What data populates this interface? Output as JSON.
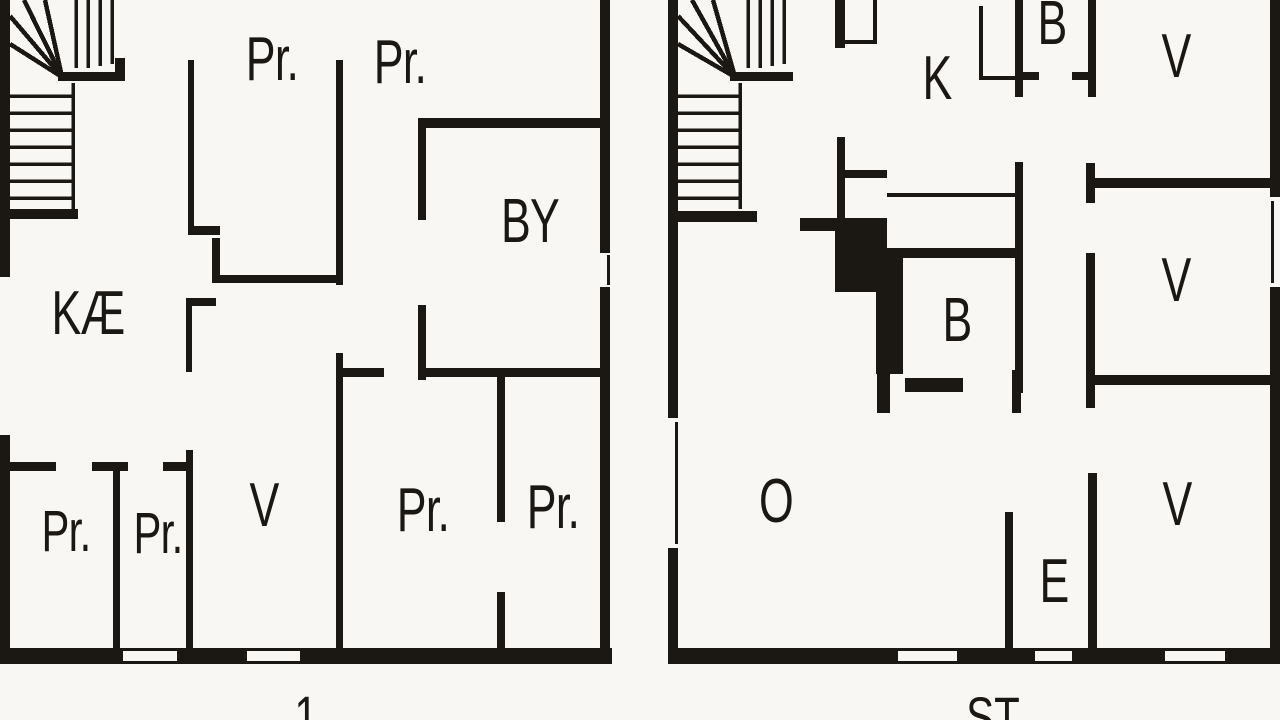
{
  "document": {
    "type": "floor-plan-drawing",
    "background_color": "#f8f7f4",
    "wall_color": "#1b1712"
  },
  "plans": {
    "left": {
      "floor_label": "1",
      "rooms": {
        "pr_top_left": "Pr.",
        "pr_top_right": "Pr.",
        "by": "BY",
        "kae": "KÆ",
        "pr_bottom_1": "Pr.",
        "pr_bottom_2": "Pr.",
        "v": "V",
        "pr_bottom_3": "Pr.",
        "pr_bottom_4": "Pr."
      }
    },
    "right": {
      "floor_label": "ST",
      "rooms": {
        "b_top": "B",
        "k": "K",
        "v_top": "V",
        "v_mid": "V",
        "b_mid": "B",
        "o": "O",
        "e": "E",
        "v_bottom": "V"
      }
    }
  }
}
